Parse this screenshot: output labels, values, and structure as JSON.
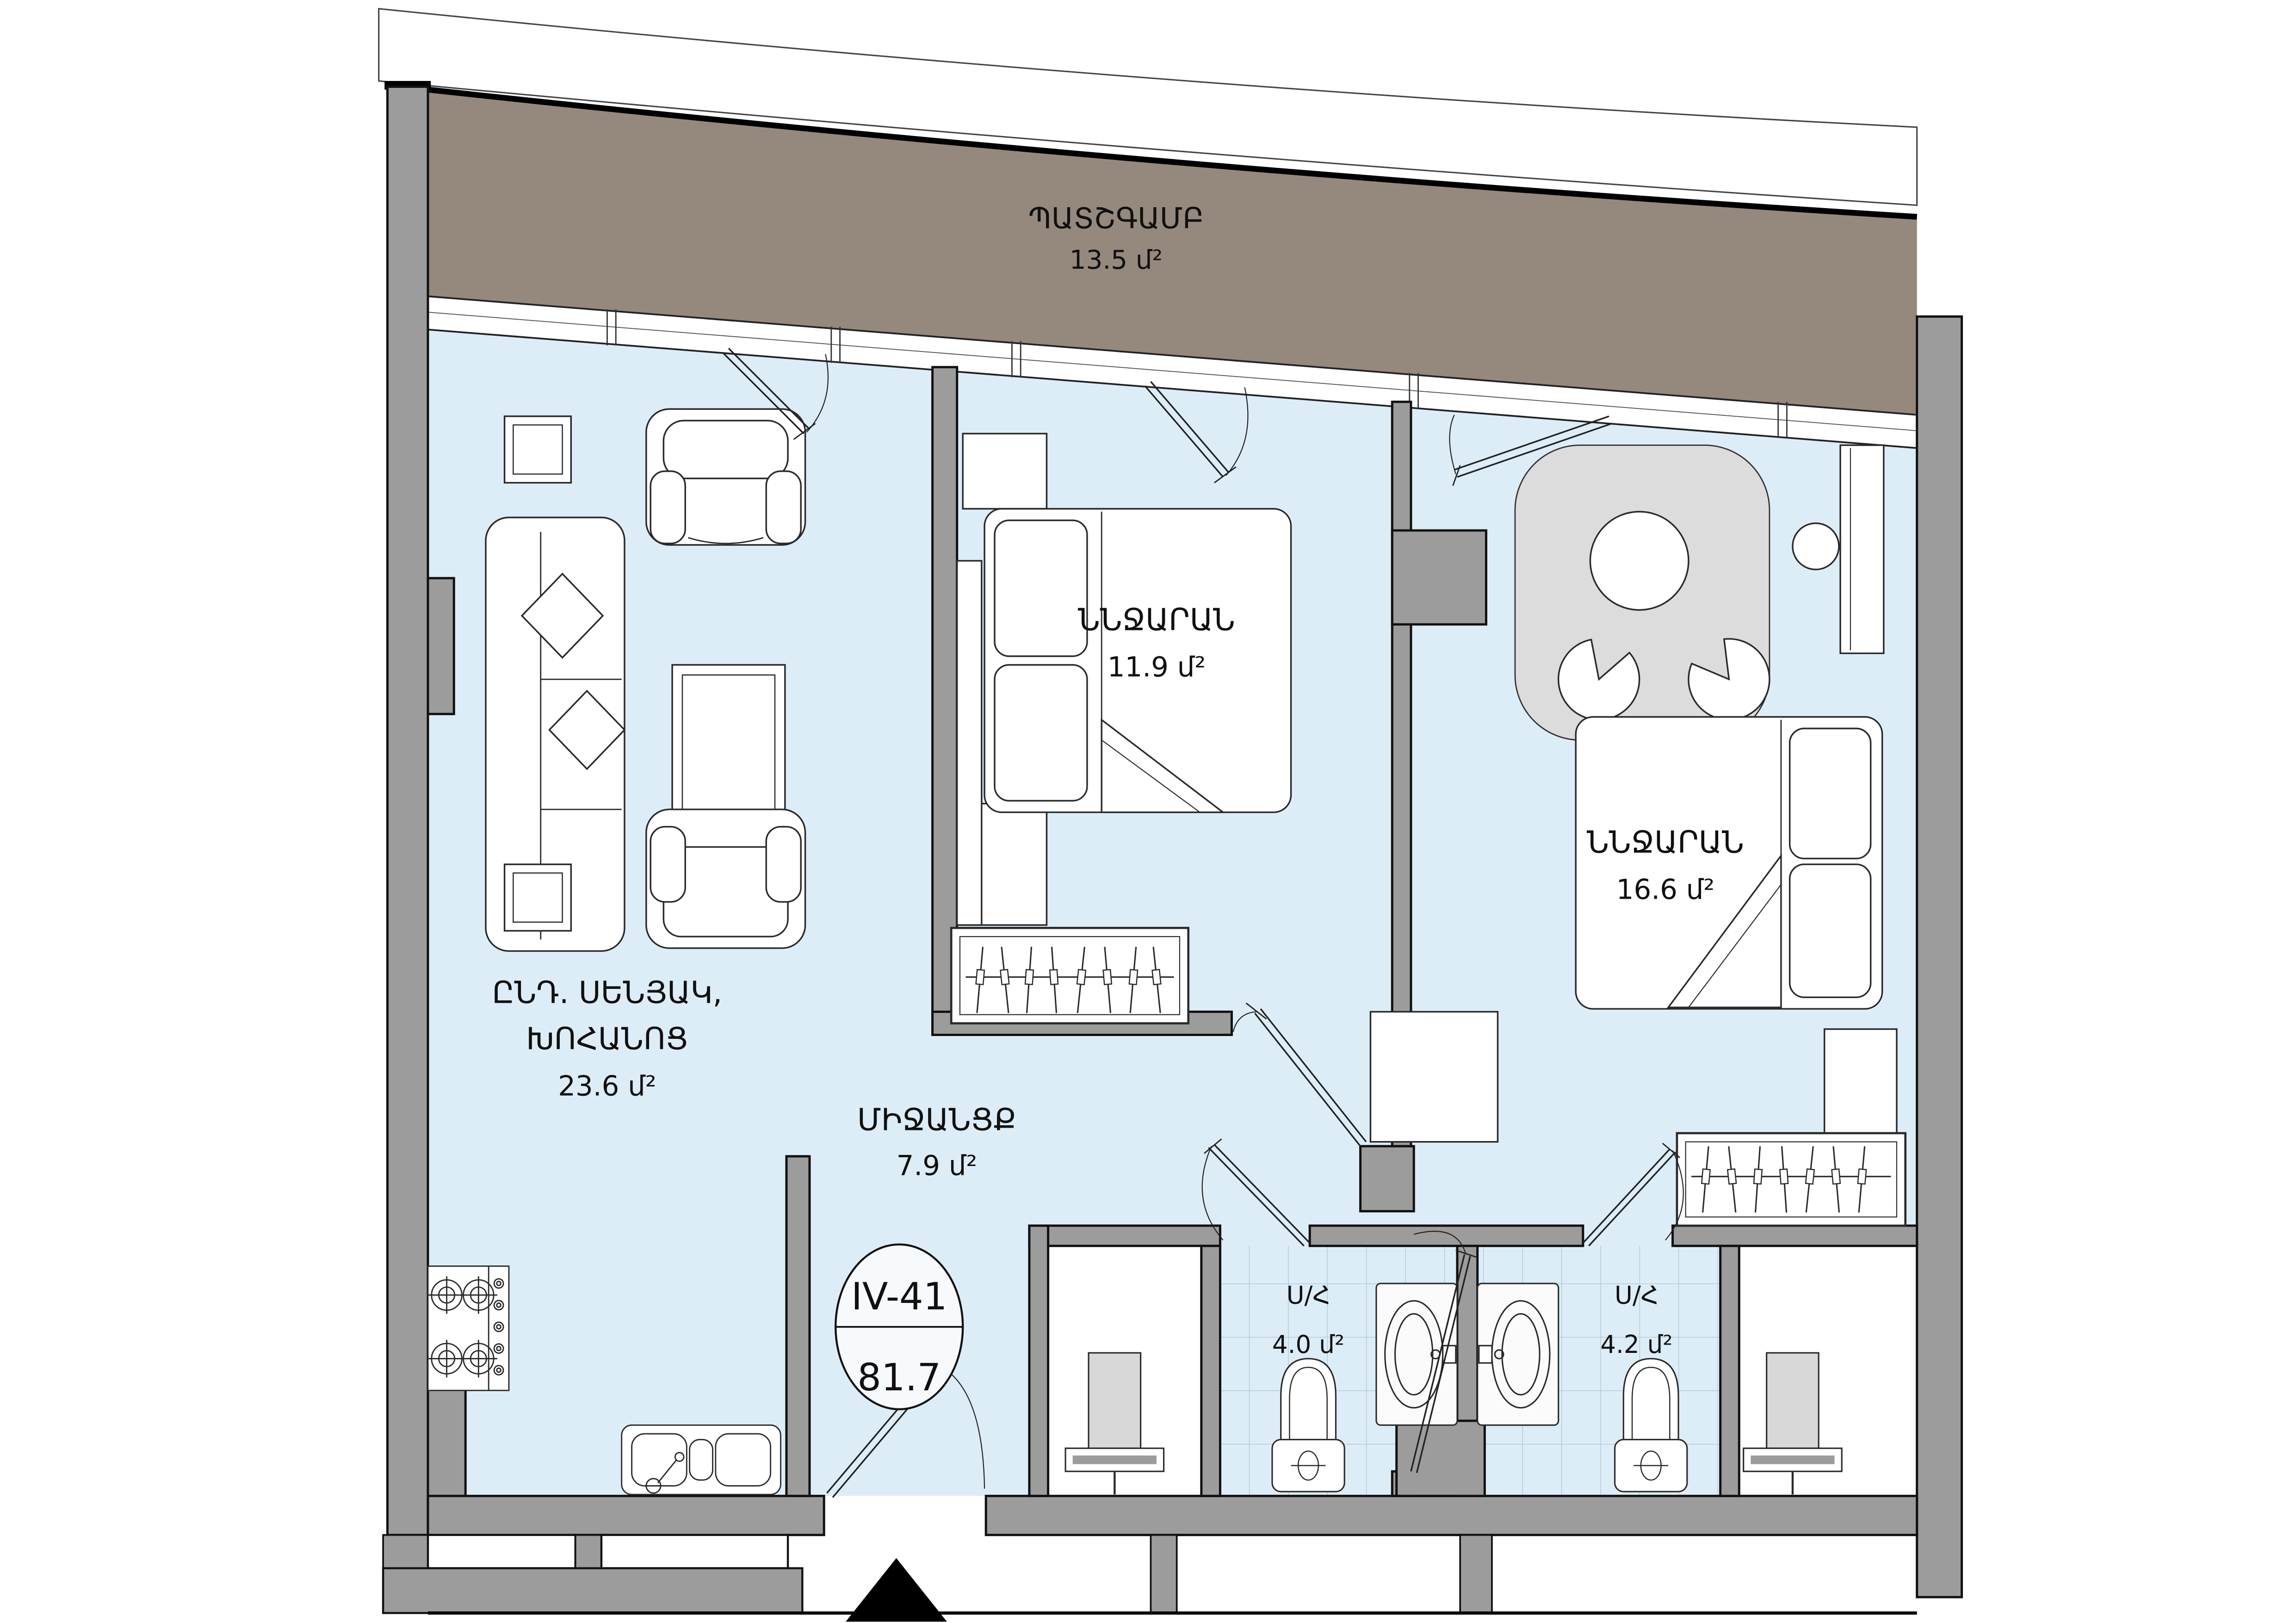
{
  "plan": {
    "unit": {
      "number": "IV-41",
      "total_area": "81.7"
    },
    "rooms": {
      "balcony": {
        "label": "ՊԱՏՇԳԱՄԲ",
        "area": "13.5 մ²"
      },
      "bedroom1": {
        "label": "ՆՆՋԱՐԱՆ",
        "area": "11.9 մ²"
      },
      "bedroom2": {
        "label": "ՆՆՋԱՐԱՆ",
        "area": "16.6 մ²"
      },
      "living": {
        "label_line1": "ԸՆԴ. ՍԵՆՅԱԿ,",
        "label_line2": "ԽՈՀԱՆՈՑ",
        "area": "23.6 մ²"
      },
      "hallway": {
        "label": "ՄԻՋԱՆՑՔ",
        "area": "7.9 մ²"
      },
      "bath1": {
        "label": "Ս/Հ",
        "area": "4.0 մ²"
      },
      "bath2": {
        "label": "Ս/Հ",
        "area": "4.2 մ²"
      }
    },
    "colors": {
      "floor": "#ddedf7",
      "balcony": "#95887d",
      "wall": "#9c9c9c",
      "rug": "#dcdcdc",
      "tile_line": "#7ba3bd",
      "outline": "#111111"
    }
  }
}
